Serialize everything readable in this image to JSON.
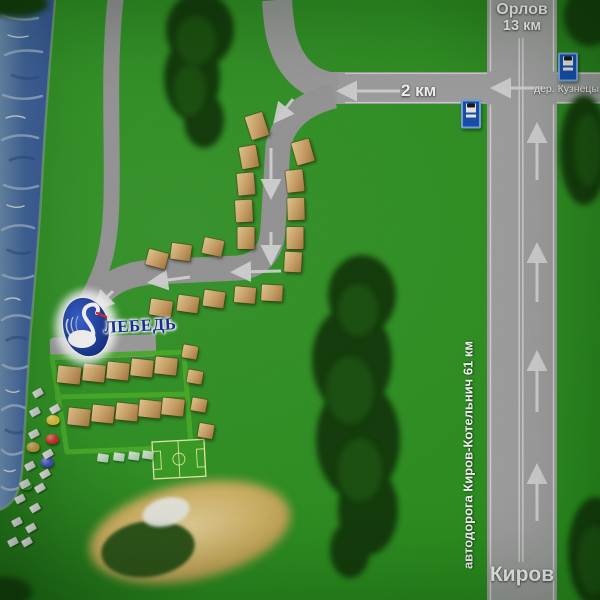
{
  "labels": {
    "top_destination": "Орлов",
    "top_distance": "13 км",
    "access_road_distance": "2 км",
    "village": "дер. Кузнецы",
    "highway": "автодорога Киров-Котельнич 61 км",
    "bottom_destination": "Киров",
    "resort_name": "ЛЕБЕДЬ"
  },
  "icons": [
    "bus-stop-icon",
    "swan-logo-icon",
    "route-arrow-icon"
  ],
  "colors": {
    "grass": "#2d9420",
    "road": "#a6a6a6",
    "road_minor": "#9d9d9d",
    "marking_white": "#e3e3e3",
    "water_deep": "#3f63a4",
    "water_light": "#7c9ccb",
    "forest_dark": "#16400c",
    "forest_light": "#215f13",
    "cabin_light": "#ecd09a",
    "cabin_dark": "#a97f44",
    "walkway_green": "#4db42c",
    "sand": "#d8ba6b",
    "pond": "#30591b",
    "field_line": "#e9f2aa",
    "logo_blue": "#16339e",
    "bus_sign_blue": "#1a52b4",
    "label_white": "#ffffff"
  },
  "entities": {
    "cabins": [
      {
        "x": 257,
        "y": 126,
        "w": 18,
        "h": 24,
        "r": -18
      },
      {
        "x": 249,
        "y": 157,
        "w": 17,
        "h": 22,
        "r": -10
      },
      {
        "x": 246,
        "y": 184,
        "w": 17,
        "h": 22,
        "r": -5
      },
      {
        "x": 244,
        "y": 211,
        "w": 17,
        "h": 22,
        "r": -3
      },
      {
        "x": 246,
        "y": 238,
        "w": 17,
        "h": 22,
        "r": 0
      },
      {
        "x": 213,
        "y": 247,
        "w": 20,
        "h": 16,
        "r": 12
      },
      {
        "x": 181,
        "y": 252,
        "w": 20,
        "h": 16,
        "r": 8
      },
      {
        "x": 157,
        "y": 259,
        "w": 20,
        "h": 16,
        "r": 15
      },
      {
        "x": 303,
        "y": 152,
        "w": 18,
        "h": 23,
        "r": -16
      },
      {
        "x": 295,
        "y": 181,
        "w": 17,
        "h": 22,
        "r": -6
      },
      {
        "x": 296,
        "y": 209,
        "w": 17,
        "h": 22,
        "r": -2
      },
      {
        "x": 295,
        "y": 238,
        "w": 17,
        "h": 22,
        "r": 0
      },
      {
        "x": 293,
        "y": 262,
        "w": 17,
        "h": 20,
        "r": 3
      },
      {
        "x": 161,
        "y": 308,
        "w": 22,
        "h": 16,
        "r": 8
      },
      {
        "x": 188,
        "y": 304,
        "w": 21,
        "h": 16,
        "r": 8
      },
      {
        "x": 214,
        "y": 299,
        "w": 21,
        "h": 16,
        "r": 8
      },
      {
        "x": 245,
        "y": 295,
        "w": 21,
        "h": 16,
        "r": 5
      },
      {
        "x": 272,
        "y": 293,
        "w": 21,
        "h": 16,
        "r": 3
      },
      {
        "x": 69,
        "y": 375,
        "w": 23,
        "h": 17,
        "r": 6
      },
      {
        "x": 94,
        "y": 373,
        "w": 22,
        "h": 17,
        "r": 6
      },
      {
        "x": 118,
        "y": 371,
        "w": 22,
        "h": 17,
        "r": 6
      },
      {
        "x": 142,
        "y": 368,
        "w": 22,
        "h": 17,
        "r": 6
      },
      {
        "x": 166,
        "y": 366,
        "w": 22,
        "h": 17,
        "r": 6
      },
      {
        "x": 79,
        "y": 417,
        "w": 22,
        "h": 17,
        "r": 6
      },
      {
        "x": 103,
        "y": 414,
        "w": 22,
        "h": 17,
        "r": 6
      },
      {
        "x": 127,
        "y": 412,
        "w": 22,
        "h": 17,
        "r": 6
      },
      {
        "x": 150,
        "y": 409,
        "w": 22,
        "h": 17,
        "r": 6
      },
      {
        "x": 173,
        "y": 407,
        "w": 22,
        "h": 17,
        "r": 6
      }
    ],
    "sheds": [
      {
        "x": 190,
        "y": 352,
        "w": 15,
        "h": 13,
        "r": 10
      },
      {
        "x": 195,
        "y": 377,
        "w": 15,
        "h": 13,
        "r": 10
      },
      {
        "x": 199,
        "y": 405,
        "w": 15,
        "h": 13,
        "r": 10
      },
      {
        "x": 206,
        "y": 431,
        "w": 15,
        "h": 14,
        "r": 10
      }
    ],
    "benches": [
      {
        "x": 103,
        "y": 458,
        "r": 8
      },
      {
        "x": 119,
        "y": 457,
        "r": 8
      },
      {
        "x": 134,
        "y": 456,
        "r": 8
      },
      {
        "x": 148,
        "y": 455,
        "r": 8
      }
    ],
    "tents": [
      {
        "x": 53,
        "y": 420,
        "c": "#e7c42f"
      },
      {
        "x": 52,
        "y": 439,
        "c": "#d63129"
      },
      {
        "x": 33,
        "y": 447,
        "c": "#c89b3f"
      },
      {
        "x": 47,
        "y": 462,
        "c": "#4052c8"
      },
      {
        "x": 26,
        "y": 485,
        "c": "#38b82a"
      }
    ],
    "camp_items": [
      {
        "x": 38,
        "y": 393,
        "r": -30
      },
      {
        "x": 55,
        "y": 409,
        "r": -30
      },
      {
        "x": 35,
        "y": 412,
        "r": -28
      },
      {
        "x": 34,
        "y": 434,
        "r": -28
      },
      {
        "x": 48,
        "y": 454,
        "r": -30
      },
      {
        "x": 30,
        "y": 466,
        "r": -28
      },
      {
        "x": 45,
        "y": 474,
        "r": -30
      },
      {
        "x": 25,
        "y": 484,
        "r": -28
      },
      {
        "x": 40,
        "y": 488,
        "r": -30
      },
      {
        "x": 20,
        "y": 499,
        "r": -28
      },
      {
        "x": 35,
        "y": 508,
        "r": -30
      },
      {
        "x": 17,
        "y": 522,
        "r": -28
      },
      {
        "x": 31,
        "y": 528,
        "r": -30
      },
      {
        "x": 13,
        "y": 542,
        "r": -28
      },
      {
        "x": 27,
        "y": 542,
        "r": -30
      }
    ],
    "bus_stops": [
      {
        "x": 471,
        "y": 114
      },
      {
        "x": 568,
        "y": 67
      }
    ]
  }
}
